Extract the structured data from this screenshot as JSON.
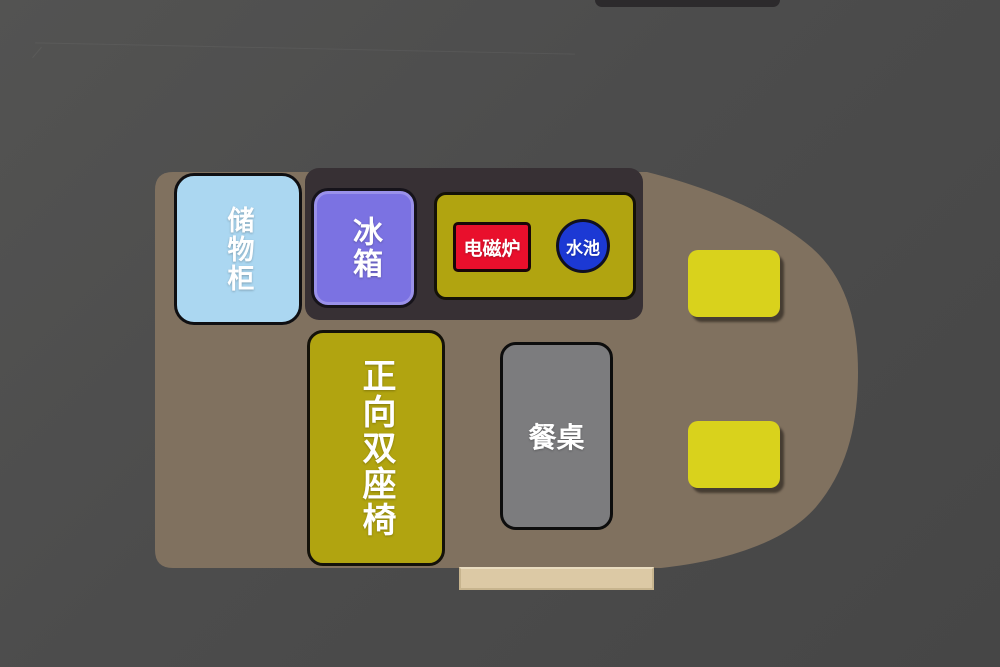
{
  "scene": {
    "background_top": "#535352",
    "background_bottom": "#464646",
    "van_body_color": "#80715f",
    "roof_bar_color": "#2c2a2c",
    "entry_step_color": "#dcc9a5"
  },
  "furniture": {
    "storage_cabinet": {
      "label": "储物柜",
      "fill": "#abd7f1"
    },
    "kitchen_block": {
      "fill": "#373034"
    },
    "fridge": {
      "label": "冰箱",
      "fill": "#7b72e2"
    },
    "counter": {
      "fill": "#b1a410"
    },
    "induction_cooker": {
      "label": "电磁炉",
      "fill": "#e90f2c"
    },
    "sink": {
      "label": "水池",
      "fill": "#1c39d4"
    },
    "double_seat": {
      "label": "正向双座椅",
      "fill": "#b1a410"
    },
    "dining_table": {
      "label": "餐桌",
      "fill": "#7c7c7e"
    },
    "cab_seat_top": {
      "fill": "#d9d21c"
    },
    "cab_seat_bottom": {
      "fill": "#d9d21c"
    }
  },
  "text_color": "#ffffff"
}
